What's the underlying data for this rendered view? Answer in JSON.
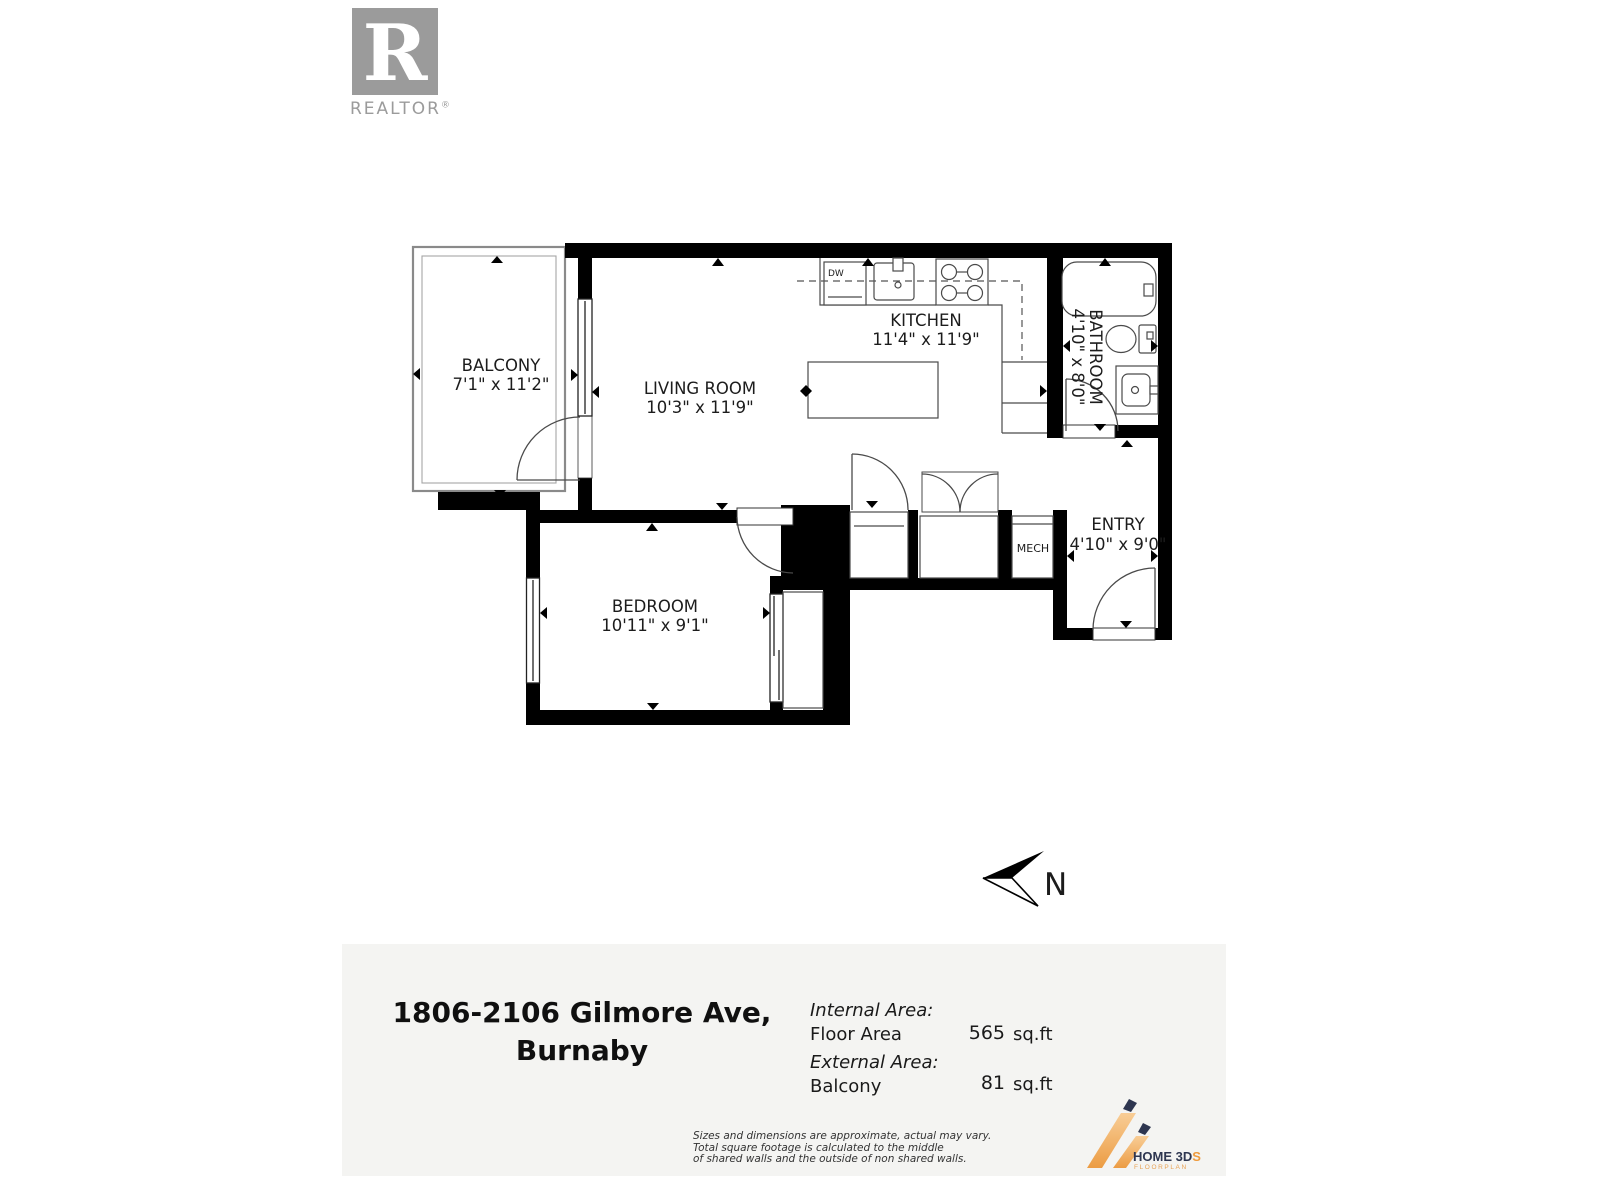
{
  "branding": {
    "logo_letter": "R",
    "logo_word": "REALTOR",
    "registered_mark": "®"
  },
  "floorplan": {
    "compass": {
      "letter": "N"
    },
    "rooms": {
      "balcony": {
        "name": "BALCONY",
        "dims": "7'1\" x 11'2\""
      },
      "living": {
        "name": "LIVING ROOM",
        "dims": "10'3\" x 11'9\""
      },
      "kitchen": {
        "name": "KITCHEN",
        "dims": "11'4\" x 11'9\""
      },
      "bathroom": {
        "name": "BATHROOM",
        "dims": "4'10\" x 8'0\""
      },
      "bedroom": {
        "name": "BEDROOM",
        "dims": "10'11\" x 9'1\""
      },
      "entry": {
        "name": "ENTRY",
        "dims": "4'10\" x 9'0\""
      },
      "mech": {
        "name": "MECH"
      }
    },
    "appliances": {
      "dishwasher": "DW"
    }
  },
  "footer": {
    "address": {
      "line1": "1806-2106 Gilmore Ave,",
      "line2": "Burnaby"
    },
    "areas": {
      "internal_label": "Internal Area:",
      "floor_area_name": "Floor Area",
      "floor_area_value": "565",
      "external_label": "External Area:",
      "balcony_name": "Balcony",
      "balcony_value": "81",
      "unit": "sq.ft"
    },
    "disclaimer": {
      "line1": "Sizes and dimensions are approximate, actual may vary.",
      "line2": "Total square footage is calculated to the middle",
      "line3": "of shared walls and the outside of non shared walls."
    },
    "vendor": {
      "name_main": "HOME 3D",
      "name_accent": "S",
      "tagline": "FLOORPLAN"
    }
  },
  "colors": {
    "wall": "#000000",
    "accent_orange": "#ef9b3d",
    "logo_navy": "#2e3650",
    "realtor_gray": "#9b9b9b",
    "footer_bg": "#f4f4f2"
  }
}
